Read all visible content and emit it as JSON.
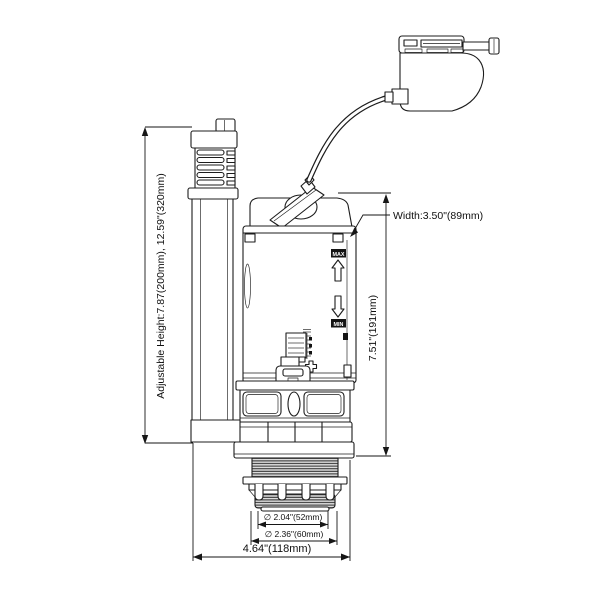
{
  "drawing": {
    "kind": "technical line drawing",
    "subject": "dual flush toilet valve with cable push-button actuator",
    "line_color": "#1c1c1c",
    "background_color": "#ffffff"
  },
  "dimensions": {
    "adjustable_height": "Adjustable Height:7.87(200mm),  12.59\"(320mm)",
    "width": "Width:3.50\"(89mm)",
    "valve_height": "7.51\"(191mm)",
    "inner_diameter": "∅ 2.04\"(52mm)",
    "outer_diameter": "∅ 2.36\"(60mm)",
    "overall_width": "4.64\"(118mm)"
  },
  "body_labels": {
    "max": "MAX",
    "min": "MIN"
  }
}
